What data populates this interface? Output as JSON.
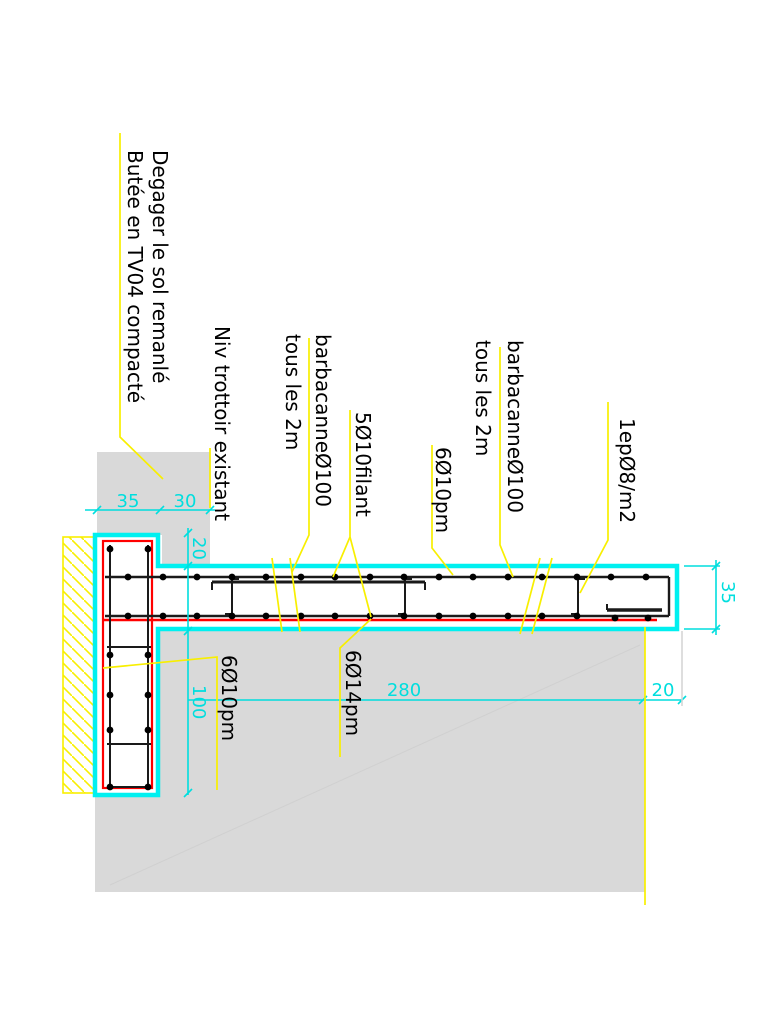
{
  "drawing": {
    "type": "construction-detail-section",
    "colors": {
      "concrete_outline": "#00f0f0",
      "rebar_cage": "#ff0000",
      "rebar_bars": "#000000",
      "leader": "#f8ef00",
      "soil_fill": "#d9d9d9",
      "hatch": "#f8ef00",
      "dimension": "#00dede",
      "background": "#ffffff"
    },
    "labels": {
      "degager_line1": "Degager le sol remanlé",
      "degager_line2": "Butée en TV04 compacté",
      "niv_trottoir": "Niv trottoir existant",
      "barbacane1_line1": "barbacanneØ100",
      "barbacane1_line2": "tous les 2m",
      "filant": "5Ø10filant",
      "bars_610_top": "6Ø10pm",
      "barbacane2_line1": "barbacanneØ100",
      "barbacane2_line2": "tous les 2m",
      "etrier": "1epØ8/m2",
      "bars_614_bottom": "6Ø14pm",
      "bars_610_bottom": "6Ø10pm"
    },
    "dimensions": {
      "top_left": "35",
      "top_right": "30",
      "step_height": "20",
      "footing_depth": "100",
      "beam_length": "280",
      "beam_end_offset": "20",
      "beam_height": "35"
    }
  }
}
